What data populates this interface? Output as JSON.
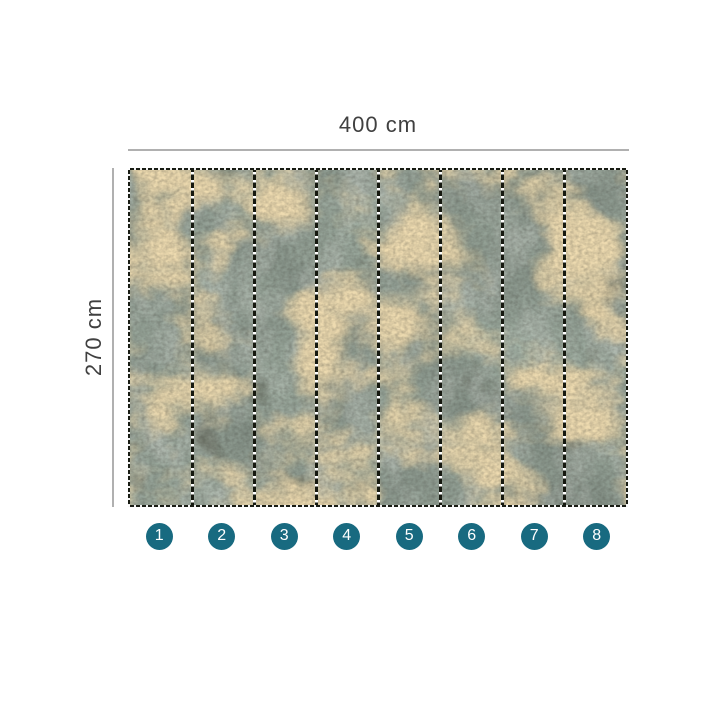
{
  "dimensions": {
    "width_label": "400 cm",
    "height_label": "270 cm"
  },
  "panels": {
    "count": 8,
    "numbers": [
      "1",
      "2",
      "3",
      "4",
      "5",
      "6",
      "7",
      "8"
    ]
  },
  "colors": {
    "background": "#ffffff",
    "badge_fill": "#186a80",
    "badge_text": "#ffffff",
    "dimension_line": "#b0b0b0",
    "dimension_text": "#404040",
    "divider_dot": "#ffffff",
    "wallpaper_base": "#47524a",
    "wallpaper_gold": "#c9a45f",
    "wallpaper_dark": "#1b1f18"
  }
}
